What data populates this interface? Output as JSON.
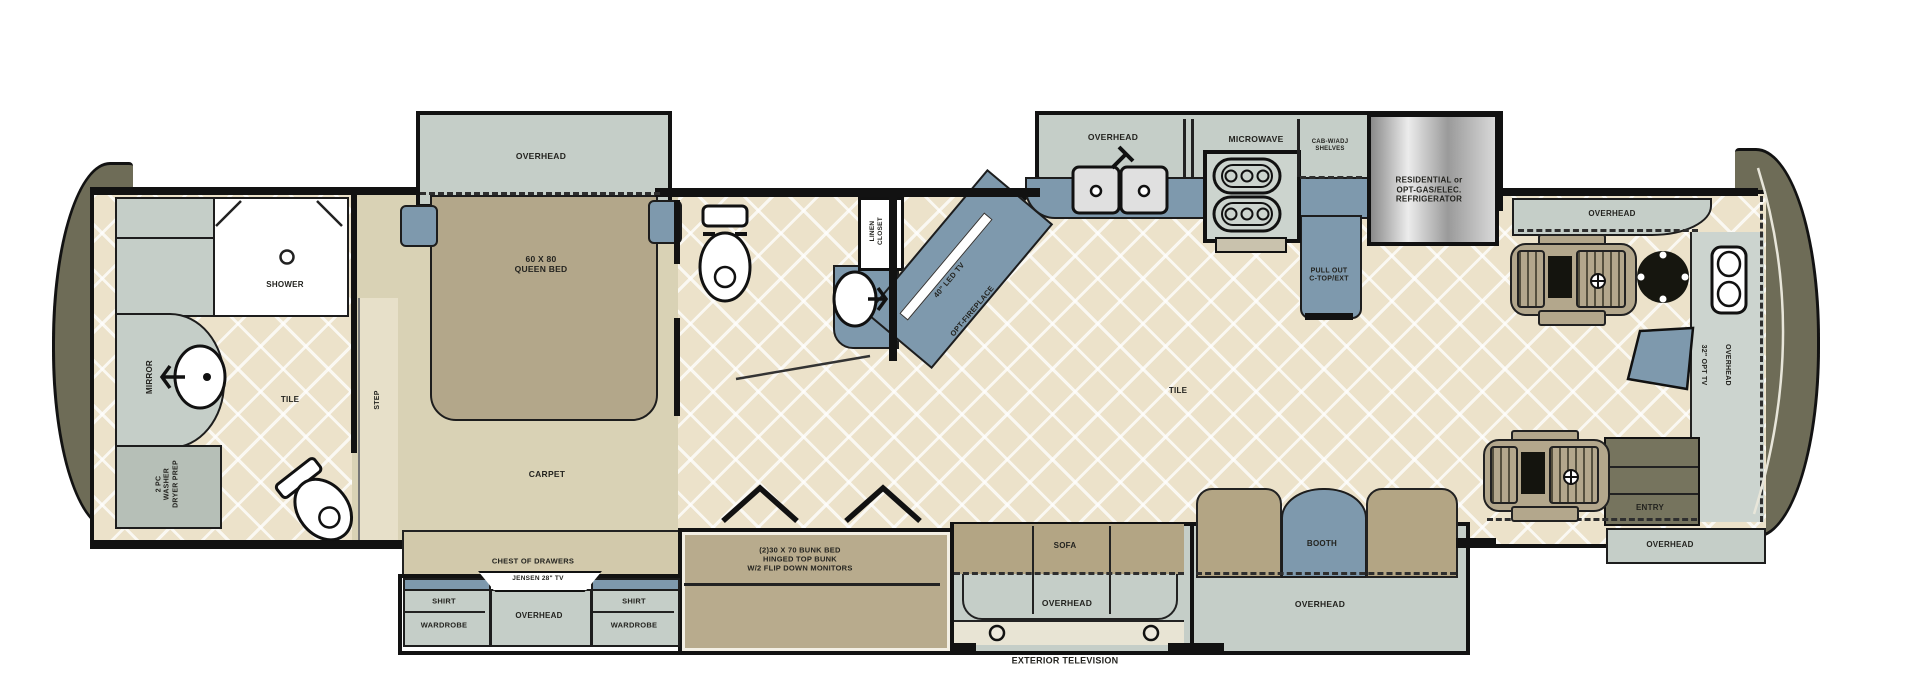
{
  "plan": {
    "rear_bath": {
      "shower": "SHOWER",
      "mirror": "MIRROR",
      "tile": "TILE",
      "washer_prep": "2 PC\nWASHER\nDRYER PREP"
    },
    "bedroom": {
      "step": "STEP",
      "overhead": "OVERHEAD",
      "queen_bed": "60 X 80\nQUEEN BED",
      "carpet": "CARPET",
      "chest": "CHEST OF DRAWERS",
      "tv": "JENSEN 28\" TV",
      "shirt_left": "SHIRT",
      "wardrobe_left": "WARDROBE",
      "overhead_bottom": "OVERHEAD",
      "shirt_right": "SHIRT",
      "wardrobe_right": "WARDROBE"
    },
    "mid_bath": {
      "linen_closet": "LINEN\nCLOSET",
      "led_tv": "40\" LED TV",
      "fireplace": "OPT-FIREPLACE"
    },
    "kitchen": {
      "overhead": "OVERHEAD",
      "microwave": "MICROWAVE",
      "cab_shelves": "CAB-W/ADJ\nSHELVES",
      "refrigerator": "RESIDENTIAL or\nOPT-GAS/ELEC.\nREFRIGERATOR",
      "pull_out": "PULL OUT\nC-TOP/EXT"
    },
    "living": {
      "tile": "TILE",
      "bunk": "(2)30 X 70 BUNK BED\nHINGED TOP BUNK\nW/2 FLIP DOWN MONITORS",
      "sofa": "SOFA",
      "sofa_overhead": "OVERHEAD",
      "booth": "BOOTH",
      "booth_overhead": "OVERHEAD",
      "exterior_tv": "EXTERIOR TELEVISION"
    },
    "front": {
      "overhead_top": "OVERHEAD",
      "opt_tv": "32\" OPT TV",
      "overhead_side": "OVERHEAD",
      "entry": "ENTRY",
      "overhead_entry": "OVERHEAD"
    }
  },
  "colors": {
    "floor_tile": "#ece2ca",
    "carpet": "#d9d2b5",
    "cabinet": "#c5cec8",
    "furniture_tan": "#b3a78a",
    "accent_blue": "#7e99ad",
    "cap_olive": "#6e6c57",
    "wall": "#121212"
  }
}
